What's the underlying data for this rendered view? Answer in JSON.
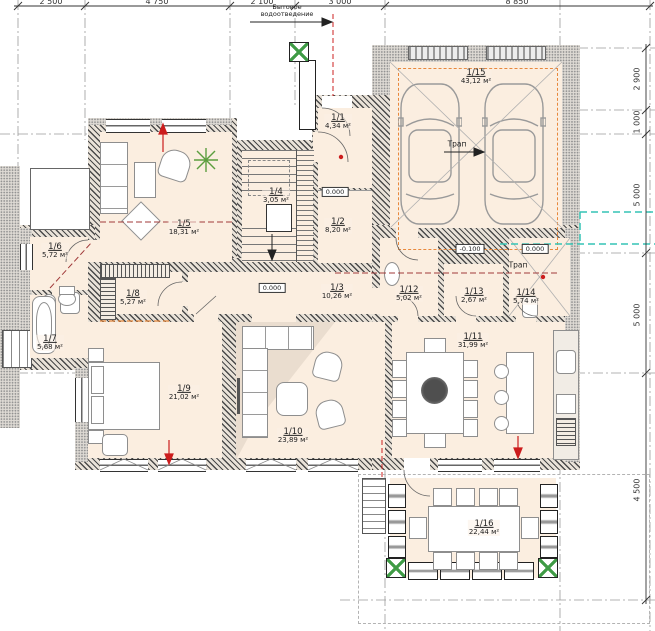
{
  "drawing": {
    "rooms": [
      {
        "id": "1/1",
        "area": "4,34 м²"
      },
      {
        "id": "1/2",
        "area": "8,20 м²"
      },
      {
        "id": "1/3",
        "area": "10,26 м²"
      },
      {
        "id": "1/4",
        "area": "3,05 м²"
      },
      {
        "id": "1/5",
        "area": "18,31 м²"
      },
      {
        "id": "1/6",
        "area": "5,72 м²"
      },
      {
        "id": "1/7",
        "area": "5,68 м²"
      },
      {
        "id": "1/8",
        "area": "5,27 м²"
      },
      {
        "id": "1/9",
        "area": "21,02 м²"
      },
      {
        "id": "1/10",
        "area": "23,89 м²"
      },
      {
        "id": "1/11",
        "area": "31,99 м²"
      },
      {
        "id": "1/12",
        "area": "5,02 м²"
      },
      {
        "id": "1/13",
        "area": "2,67 м²"
      },
      {
        "id": "1/14",
        "area": "5,74 м²"
      },
      {
        "id": "1/15",
        "area": "43,12 м²"
      },
      {
        "id": "1/16",
        "area": "22,44 м²"
      }
    ],
    "dims": {
      "top": [
        "2 500",
        "4 750",
        "2 100",
        "3 000",
        "8 850"
      ],
      "right": [
        "2 900",
        "1 000",
        "5 000",
        "5 000",
        "4 500"
      ]
    },
    "levels": {
      "zero": "0.000",
      "minus": "-0.100"
    },
    "notes": {
      "sewer": "Бытовое водоотведение",
      "drain": "Трап"
    },
    "colors": {
      "room_fill": "#fbeee0",
      "wall_hatch": "#4a4a4a",
      "accent_orange": "#e8883c",
      "accent_red": "#cc1d1d",
      "utility_teal": "#35c4b5",
      "maroon_dashed": "#a03a3a",
      "grid_grey": "#999999",
      "column_green": "#3f9b45"
    }
  }
}
